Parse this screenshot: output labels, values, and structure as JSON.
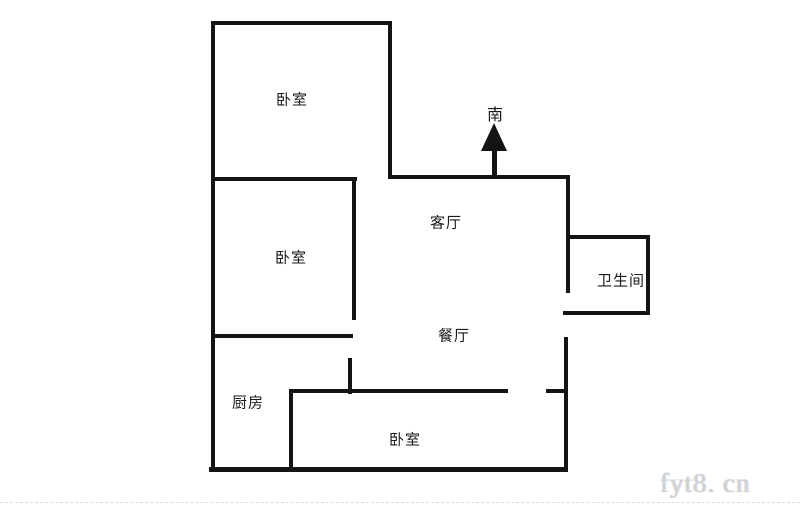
{
  "floor_plan": {
    "rooms": [
      {
        "id": "bedroom-top",
        "label": "卧室"
      },
      {
        "id": "bedroom-middle",
        "label": "卧室"
      },
      {
        "id": "living-room",
        "label": "客厅"
      },
      {
        "id": "bathroom",
        "label": "卫生间"
      },
      {
        "id": "dining-room",
        "label": "餐厅"
      },
      {
        "id": "kitchen",
        "label": "厨房"
      },
      {
        "id": "bedroom-bottom",
        "label": "卧室"
      }
    ],
    "compass": {
      "label": "南",
      "direction": "south",
      "arrow": "up"
    },
    "colors": {
      "wall": "#141414",
      "text": "#1a1a1a",
      "background": "#ffffff",
      "watermark": "#cdd1da"
    }
  },
  "watermark": {
    "text": "fyt8. cn"
  }
}
